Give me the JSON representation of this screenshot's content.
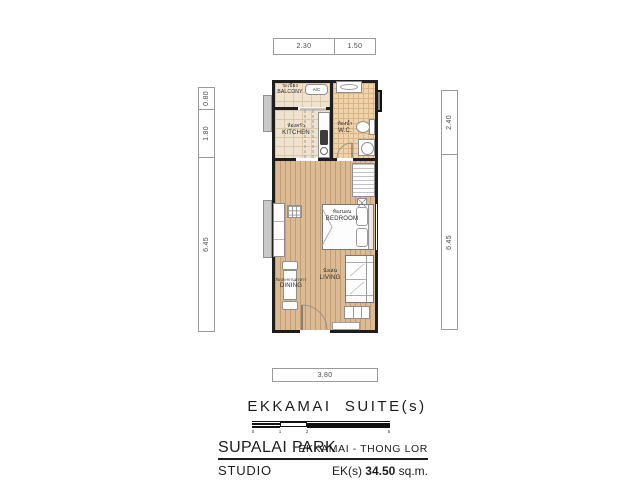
{
  "dims": {
    "top": [
      "2.30",
      "1.50"
    ],
    "left": [
      "0.80",
      "1.80",
      "6.45"
    ],
    "right": [
      "2.40",
      "6.45"
    ],
    "bottom": [
      "3.80"
    ]
  },
  "plan": {
    "balcony_th": "ระเบียง",
    "balcony_en": "BALCONY",
    "kitchen_th": "ห้องครัว",
    "kitchen_en": "KITCHEN",
    "wc_th": "ห้องน้ำ",
    "wc_en": "W.C.",
    "bedroom_th": "ห้องนอน",
    "bedroom_en": "BEDROOM",
    "dining_th": "รับประทานอาหาร",
    "dining_en": "DINING",
    "living_th": "นั่งเล่น",
    "living_en": "LIVING",
    "ac_label": "A/C"
  },
  "scalebar": {
    "t0": "0",
    "t1": "1",
    "t2": "2",
    "t5": "5"
  },
  "title": {
    "plan_name": "EKKAMAI  SUITE(s)",
    "project": "SUPALAI PARK",
    "location": "EKKAMAI - THONG LOR",
    "unit_type": "STUDIO",
    "area_code": "EK(s) ",
    "area_value": "34.50",
    "area_unit": " sq.m."
  },
  "colors": {
    "wall": "#1e1e1e",
    "wood_floor": "#dcbb94",
    "tile_floor": "#efe3cf",
    "wc_tile_floor": "#eed3ab",
    "planter_gray": "#c9c9c9"
  }
}
